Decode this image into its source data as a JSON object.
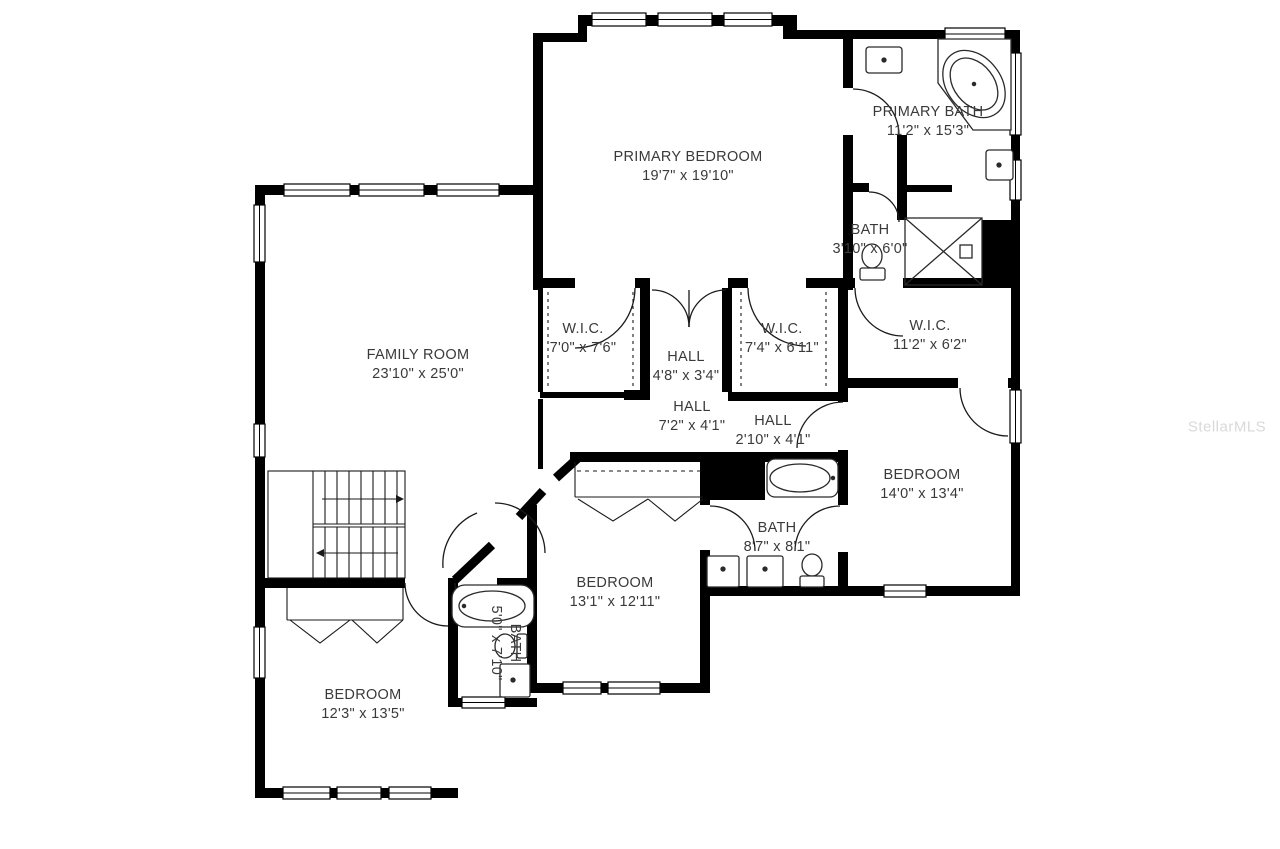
{
  "watermark": {
    "text": "StellarMLS",
    "color": "#d9d9d9"
  },
  "colors": {
    "wall": "#000000",
    "label": "#3a3a3a",
    "fixture": "#2a2a2a",
    "background": "#ffffff"
  },
  "rooms": [
    {
      "id": "primary-bedroom",
      "name": "PRIMARY BEDROOM",
      "dims": "19'7\" x 19'10\""
    },
    {
      "id": "primary-bath",
      "name": "PRIMARY BATH",
      "dims": "11'2\" x 15'3\""
    },
    {
      "id": "bath-wc",
      "name": "BATH",
      "dims": "3'10\" x 6'0\""
    },
    {
      "id": "wic-1",
      "name": "W.I.C.",
      "dims": "7'0\" x 7'6\""
    },
    {
      "id": "hall-1",
      "name": "HALL",
      "dims": "4'8\" x 3'4\""
    },
    {
      "id": "wic-2",
      "name": "W.I.C.",
      "dims": "7'4\" x 6'11\""
    },
    {
      "id": "wic-3",
      "name": "W.I.C.",
      "dims": "11'2\" x 6'2\""
    },
    {
      "id": "family-room",
      "name": "FAMILY ROOM",
      "dims": "23'10\" x 25'0\""
    },
    {
      "id": "hall-2",
      "name": "HALL",
      "dims": "7'2\" x 4'1\""
    },
    {
      "id": "hall-3",
      "name": "HALL",
      "dims": "2'10\" x 4'1\""
    },
    {
      "id": "bedroom-right",
      "name": "BEDROOM",
      "dims": "14'0\" x 13'4\""
    },
    {
      "id": "bath-jackjill",
      "name": "BATH",
      "dims": "8'7\" x 8'1\""
    },
    {
      "id": "bedroom-middle",
      "name": "BEDROOM",
      "dims": "13'1\" x 12'11\""
    },
    {
      "id": "bath-small",
      "name": "BATH",
      "dims": "5'0\" x 7'10\""
    },
    {
      "id": "bedroom-left",
      "name": "BEDROOM",
      "dims": "12'3\" x 13'5\""
    }
  ]
}
